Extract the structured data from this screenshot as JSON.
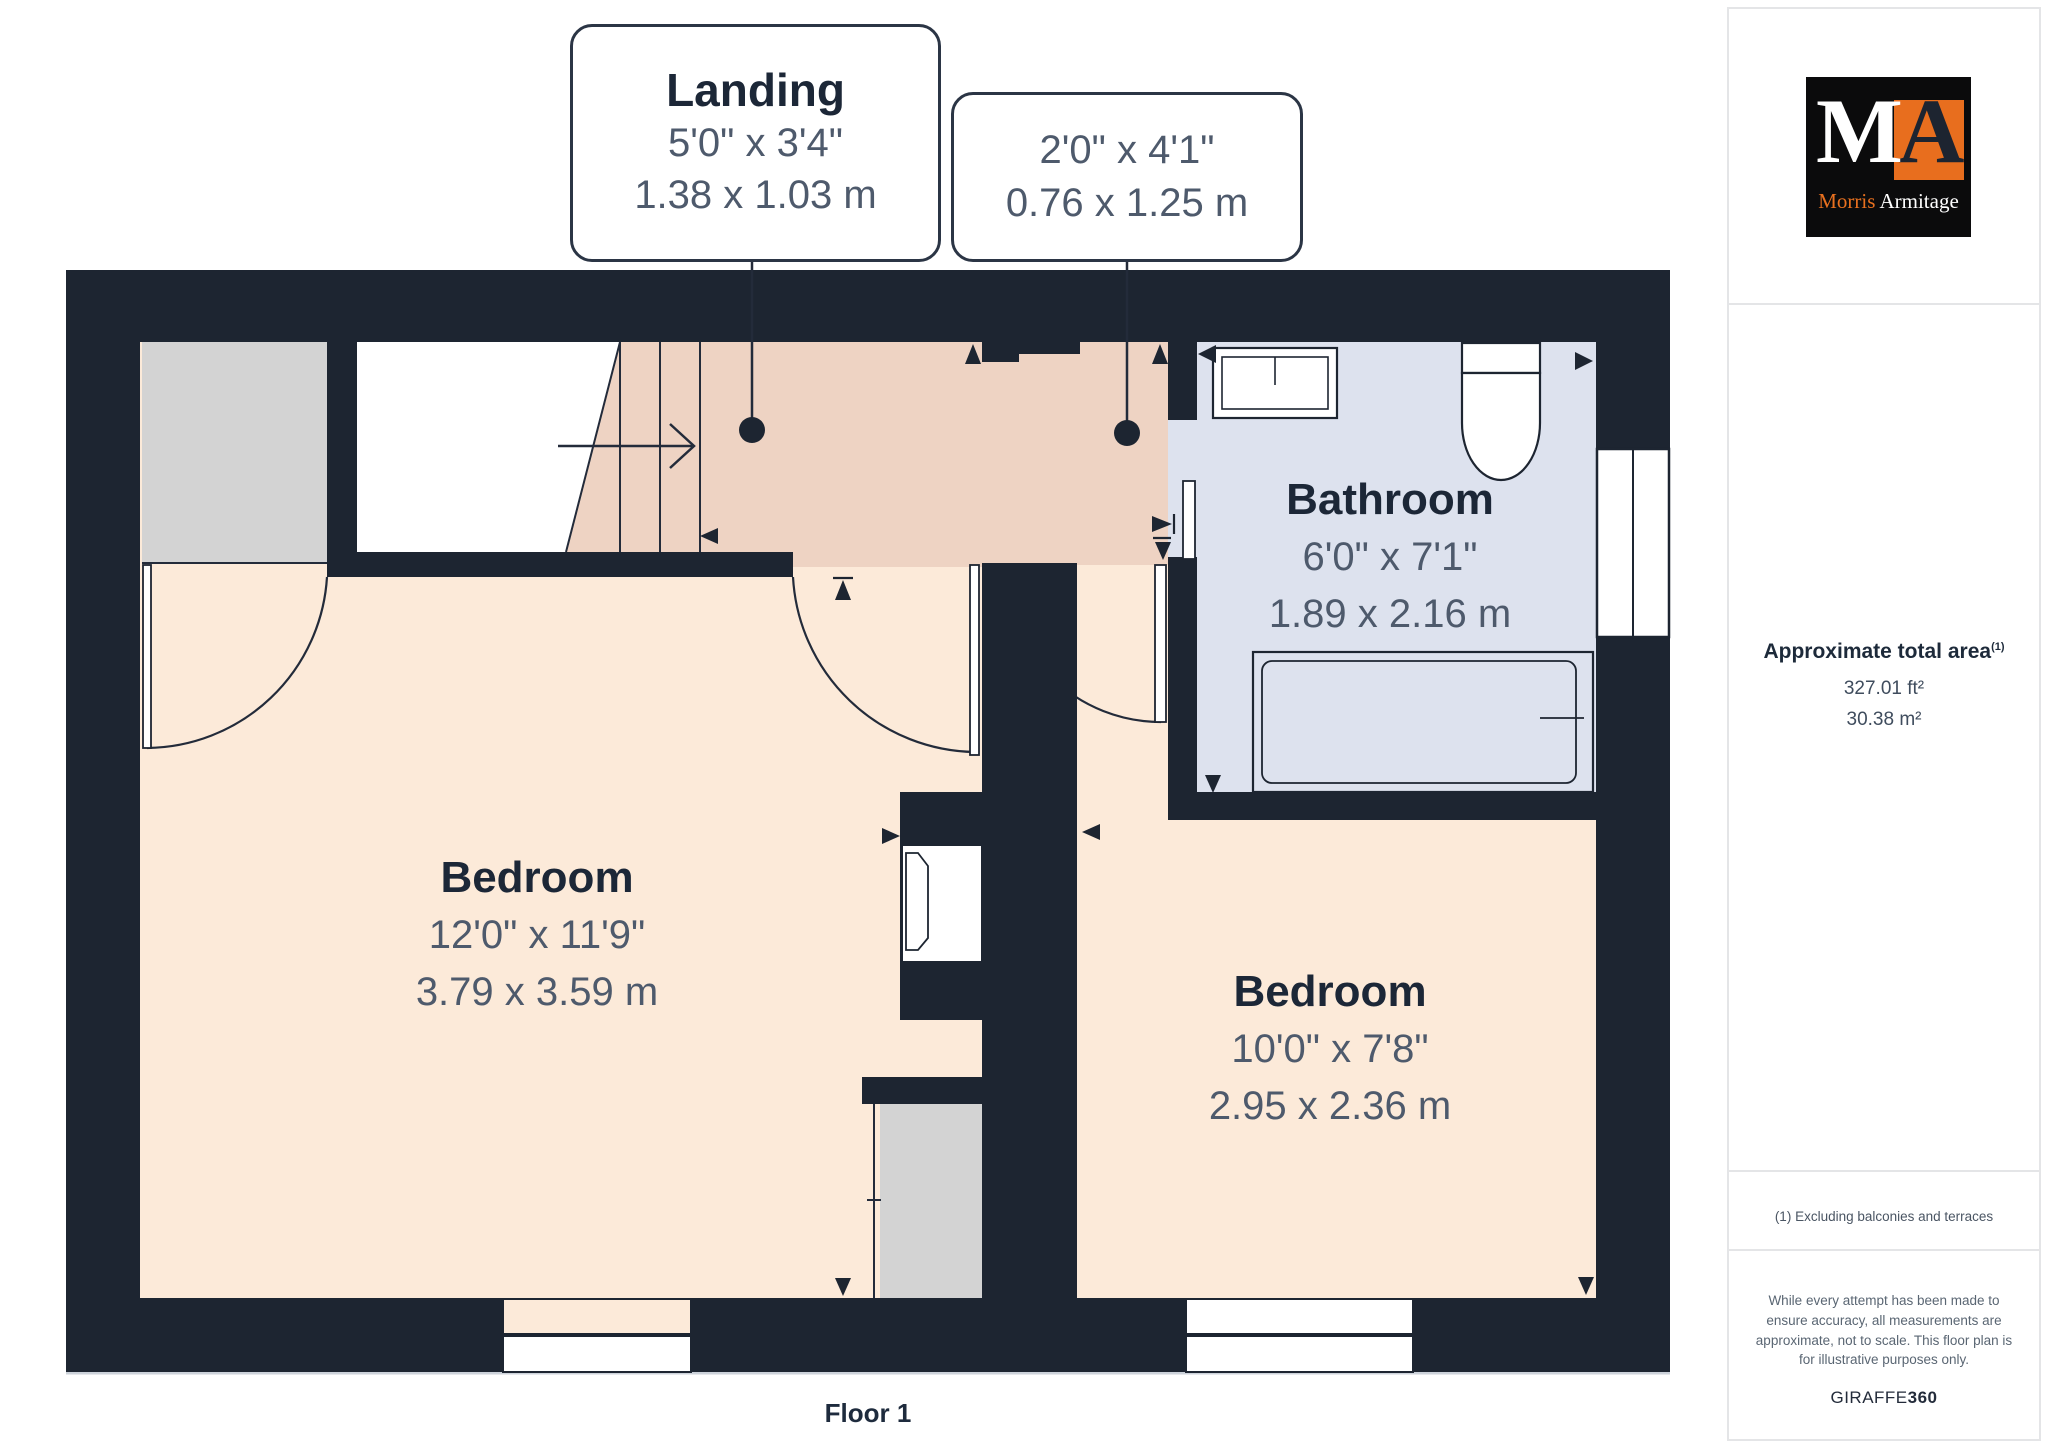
{
  "floor_label": "Floor 1",
  "callouts": [
    {
      "name": "Landing",
      "imperial": "5'0\" x 3'4\"",
      "metric": "1.38 x 1.03 m"
    },
    {
      "imperial": "2'0\" x 4'1\"",
      "metric": "0.76 x 1.25 m"
    }
  ],
  "rooms": [
    {
      "name": "Bedroom",
      "imperial": "12'0\" x 11'9\"",
      "metric": "3.79 x 3.59 m"
    },
    {
      "name": "Bedroom",
      "imperial": "10'0\" x 7'8\"",
      "metric": "2.95 x 2.36 m"
    },
    {
      "name": "Bathroom",
      "imperial": "6'0\" x 7'1\"",
      "metric": "1.89 x 2.16 m"
    }
  ],
  "sidebar": {
    "logo": {
      "monogram_m": "M",
      "monogram_a": "A",
      "name_first": "Morris",
      "name_last": "Armitage"
    },
    "area_heading": "Approximate total area",
    "area_superscript": "(1)",
    "area_imperial": "327.01 ft²",
    "area_metric": "30.38 m²",
    "footnote": "(1) Excluding balconies and terraces",
    "disclaimer": "While every attempt has been made to ensure accuracy, all measurements are approximate, not to scale. This floor plan is for illustrative purposes only.",
    "brand": "GIRAFFE",
    "brand_suffix": "360"
  },
  "colors": {
    "wall": "#1d2531",
    "bedroom_floor": "#fcead9",
    "landing_floor": "#eed3c3",
    "bathroom_floor": "#dde2ee",
    "void_gray": "#d3d3d3",
    "accent_orange": "#e86e1e",
    "line": "#232b3a"
  }
}
